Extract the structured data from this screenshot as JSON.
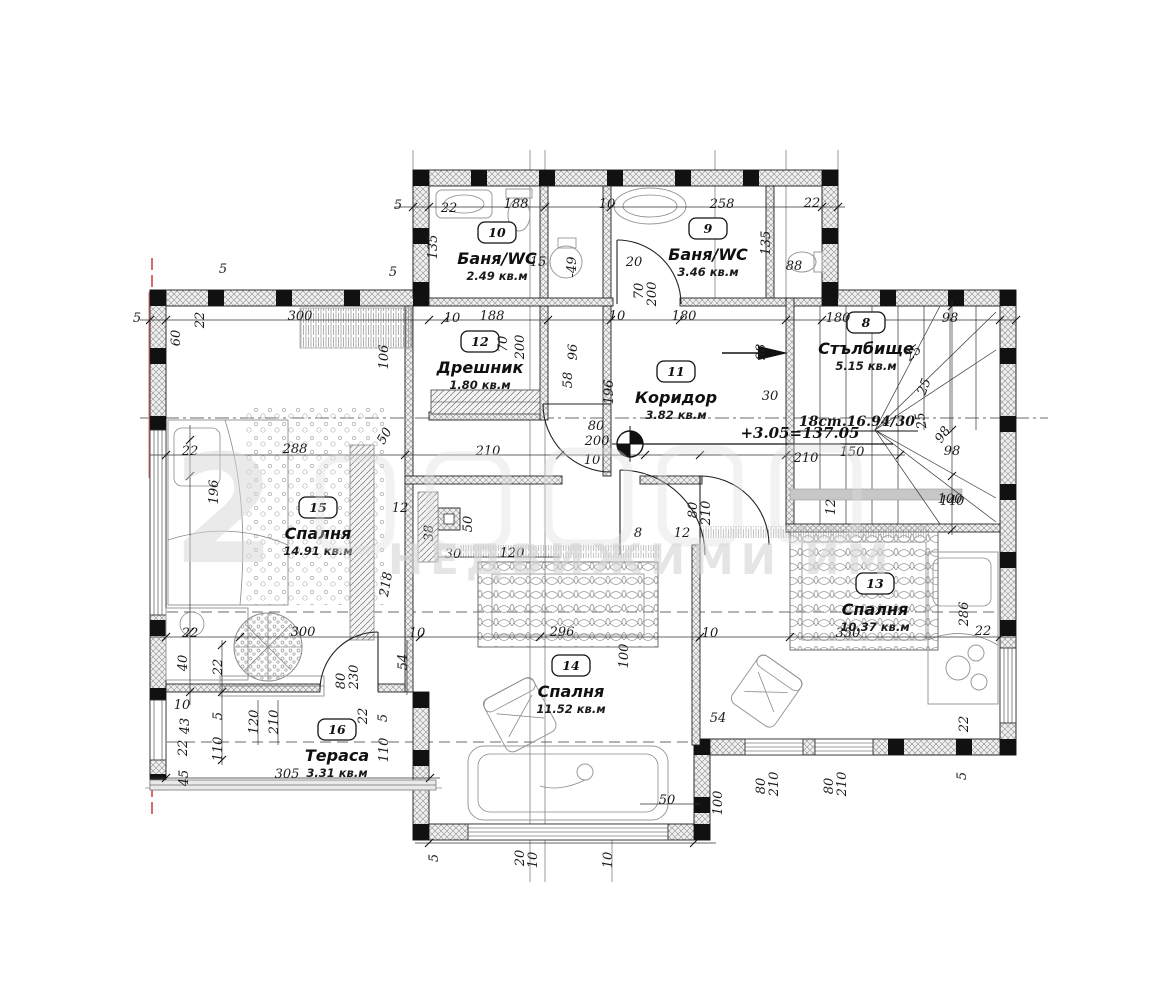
{
  "title": "Floor plan drawing",
  "watermark": {
    "big_glyph": "2",
    "line2": "НЕДВИЖИМИ ИМ"
  },
  "level_mark": {
    "text": "+3.05=137.05"
  },
  "stairs_note": {
    "text": "18ст.16.94/30"
  },
  "colors": {
    "wall": "#1a1a1a",
    "red_axis": "#cc4444",
    "watermark": "#d4d4d4",
    "paper": "#ffffff"
  },
  "rooms": [
    {
      "number": "10",
      "name": "Баня/WC",
      "area": "2.49 кв.м",
      "x": 497,
      "y": 233
    },
    {
      "number": "9",
      "name": "Баня/WC",
      "area": "3.46 кв.м",
      "x": 708,
      "y": 229
    },
    {
      "number": "12",
      "name": "Дрешник",
      "area": "1.80 кв.м",
      "x": 480,
      "y": 342
    },
    {
      "number": "11",
      "name": "Коридор",
      "area": "3.82 кв.м",
      "x": 676,
      "y": 372
    },
    {
      "number": "8",
      "name": "Стълбище",
      "area": "5.15 кв.м",
      "x": 866,
      "y": 323
    },
    {
      "number": "15",
      "name": "Спалня",
      "area": "14.91 кв.м",
      "x": 318,
      "y": 508
    },
    {
      "number": "13",
      "name": "Спалня",
      "area": "10.37 кв.м",
      "x": 875,
      "y": 584
    },
    {
      "number": "14",
      "name": "Спалня",
      "area": "11.52 кв.м",
      "x": 571,
      "y": 666
    },
    {
      "number": "16",
      "name": "Тераса",
      "area": "3.31 кв.м",
      "x": 337,
      "y": 730
    }
  ],
  "dimensions": [
    {
      "t": "5",
      "x": 398,
      "y": 209
    },
    {
      "t": "22",
      "x": 449,
      "y": 212
    },
    {
      "t": "188",
      "x": 516,
      "y": 208
    },
    {
      "t": "10",
      "x": 607,
      "y": 208
    },
    {
      "t": "258",
      "x": 722,
      "y": 208
    },
    {
      "t": "22",
      "x": 812,
      "y": 207
    },
    {
      "t": "135",
      "x": 437,
      "y": 247,
      "r": -90
    },
    {
      "t": "135",
      "x": 770,
      "y": 243,
      "r": -90
    },
    {
      "t": "88",
      "x": 794,
      "y": 270
    },
    {
      "t": "15",
      "x": 538,
      "y": 266
    },
    {
      "t": "20",
      "x": 634,
      "y": 266
    },
    {
      "t": "70",
      "x": 643,
      "y": 291,
      "r": -90
    },
    {
      "t": "200",
      "x": 656,
      "y": 294,
      "r": -90
    },
    {
      "t": "-49",
      "x": 576,
      "y": 267,
      "r": -90
    },
    {
      "t": "5",
      "x": 223,
      "y": 273
    },
    {
      "t": "5",
      "x": 393,
      "y": 276
    },
    {
      "t": "5",
      "x": 137,
      "y": 322
    },
    {
      "t": "300",
      "x": 300,
      "y": 320
    },
    {
      "t": "60",
      "x": 180,
      "y": 338,
      "r": -90
    },
    {
      "t": "22",
      "x": 204,
      "y": 320,
      "r": -90
    },
    {
      "t": "106",
      "x": 388,
      "y": 357,
      "r": -90
    },
    {
      "t": "10",
      "x": 452,
      "y": 322
    },
    {
      "t": "188",
      "x": 492,
      "y": 320
    },
    {
      "t": "70",
      "x": 507,
      "y": 344,
      "r": -90
    },
    {
      "t": "200",
      "x": 524,
      "y": 347,
      "r": -90
    },
    {
      "t": "10",
      "x": 617,
      "y": 320
    },
    {
      "t": "180",
      "x": 684,
      "y": 320
    },
    {
      "t": "96",
      "x": 577,
      "y": 352,
      "r": -90
    },
    {
      "t": "58",
      "x": 572,
      "y": 380,
      "r": -90
    },
    {
      "t": "196",
      "x": 613,
      "y": 392,
      "r": -90
    },
    {
      "t": "98",
      "x": 765,
      "y": 352,
      "r": -90
    },
    {
      "t": "30",
      "x": 770,
      "y": 400
    },
    {
      "t": "180",
      "x": 838,
      "y": 322
    },
    {
      "t": "98",
      "x": 950,
      "y": 322
    },
    {
      "t": "98",
      "x": 946,
      "y": 437,
      "r": -55
    },
    {
      "t": "98",
      "x": 952,
      "y": 455
    },
    {
      "t": "140",
      "x": 952,
      "y": 505
    },
    {
      "t": "150",
      "x": 852,
      "y": 456
    },
    {
      "t": "25",
      "x": 916,
      "y": 356,
      "r": -40
    },
    {
      "t": "25",
      "x": 928,
      "y": 388,
      "r": -70
    },
    {
      "t": "25",
      "x": 925,
      "y": 420,
      "r": -100
    },
    {
      "t": "22",
      "x": 190,
      "y": 455
    },
    {
      "t": "288",
      "x": 295,
      "y": 453
    },
    {
      "t": "50",
      "x": 388,
      "y": 438,
      "r": -60
    },
    {
      "t": "196",
      "x": 218,
      "y": 492,
      "r": -90
    },
    {
      "t": "218",
      "x": 390,
      "y": 585,
      "r": -80
    },
    {
      "t": "210",
      "x": 488,
      "y": 455
    },
    {
      "t": "80",
      "x": 596,
      "y": 430
    },
    {
      "t": "200",
      "x": 597,
      "y": 445
    },
    {
      "t": "10",
      "x": 592,
      "y": 464
    },
    {
      "t": "210",
      "x": 806,
      "y": 462
    },
    {
      "t": "12",
      "x": 400,
      "y": 512
    },
    {
      "t": "38",
      "x": 433,
      "y": 533,
      "r": -90
    },
    {
      "t": "50",
      "x": 472,
      "y": 524,
      "r": -90
    },
    {
      "t": "30",
      "x": 453,
      "y": 558
    },
    {
      "t": "120",
      "x": 512,
      "y": 557
    },
    {
      "t": "8",
      "x": 638,
      "y": 537
    },
    {
      "t": "12",
      "x": 682,
      "y": 537
    },
    {
      "t": "80",
      "x": 697,
      "y": 510,
      "r": -90
    },
    {
      "t": "210",
      "x": 710,
      "y": 513,
      "r": -90
    },
    {
      "t": "12",
      "x": 835,
      "y": 507,
      "r": -90
    },
    {
      "t": "296",
      "x": 562,
      "y": 636
    },
    {
      "t": "100",
      "x": 628,
      "y": 656,
      "r": -90
    },
    {
      "t": "10",
      "x": 710,
      "y": 637
    },
    {
      "t": "54",
      "x": 718,
      "y": 722
    },
    {
      "t": "350",
      "x": 848,
      "y": 637
    },
    {
      "t": "22",
      "x": 983,
      "y": 635
    },
    {
      "t": "286",
      "x": 968,
      "y": 614,
      "r": -90
    },
    {
      "t": "100",
      "x": 950,
      "y": 503
    },
    {
      "t": "22",
      "x": 968,
      "y": 724,
      "r": -90
    },
    {
      "t": "5",
      "x": 966,
      "y": 776,
      "r": -90
    },
    {
      "t": "22",
      "x": 190,
      "y": 637
    },
    {
      "t": "40",
      "x": 187,
      "y": 663,
      "r": -90
    },
    {
      "t": "22",
      "x": 222,
      "y": 667,
      "r": -90
    },
    {
      "t": "300",
      "x": 303,
      "y": 636
    },
    {
      "t": "10",
      "x": 417,
      "y": 637
    },
    {
      "t": "54",
      "x": 407,
      "y": 662,
      "r": -90
    },
    {
      "t": "80",
      "x": 345,
      "y": 681,
      "r": -90
    },
    {
      "t": "230",
      "x": 358,
      "y": 677,
      "r": -90
    },
    {
      "t": "10",
      "x": 182,
      "y": 709
    },
    {
      "t": "5",
      "x": 222,
      "y": 716,
      "r": -90
    },
    {
      "t": "43",
      "x": 189,
      "y": 726,
      "r": -90
    },
    {
      "t": "22",
      "x": 187,
      "y": 748,
      "r": -90
    },
    {
      "t": "110",
      "x": 222,
      "y": 749,
      "r": -90
    },
    {
      "t": "45",
      "x": 188,
      "y": 778,
      "r": -90
    },
    {
      "t": "120",
      "x": 258,
      "y": 722,
      "r": -90
    },
    {
      "t": "210",
      "x": 278,
      "y": 722,
      "r": -90
    },
    {
      "t": "110",
      "x": 388,
      "y": 750,
      "r": -90
    },
    {
      "t": "22",
      "x": 367,
      "y": 716,
      "r": -90
    },
    {
      "t": "5",
      "x": 387,
      "y": 718,
      "r": -90
    },
    {
      "t": "305",
      "x": 287,
      "y": 778
    },
    {
      "t": "50",
      "x": 667,
      "y": 804
    },
    {
      "t": "100",
      "x": 722,
      "y": 803,
      "r": -90
    },
    {
      "t": "80",
      "x": 765,
      "y": 786,
      "r": -90
    },
    {
      "t": "210",
      "x": 778,
      "y": 784,
      "r": -90
    },
    {
      "t": "80",
      "x": 833,
      "y": 786,
      "r": -90
    },
    {
      "t": "210",
      "x": 846,
      "y": 784,
      "r": -90
    },
    {
      "t": "5",
      "x": 438,
      "y": 858,
      "r": -90
    },
    {
      "t": "20",
      "x": 524,
      "y": 858,
      "r": -90
    },
    {
      "t": "10",
      "x": 537,
      "y": 860,
      "r": -90
    },
    {
      "t": "10",
      "x": 612,
      "y": 860,
      "r": -90
    }
  ]
}
